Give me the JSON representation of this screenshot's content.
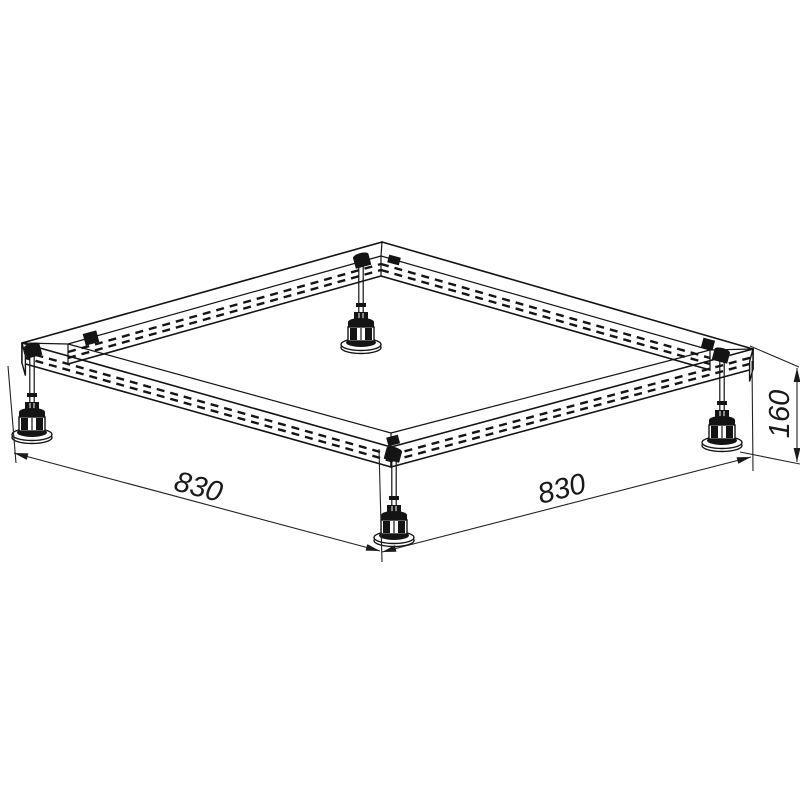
{
  "drawing": {
    "labels": {
      "width_left": "830",
      "width_right": "830",
      "height": "160"
    },
    "line_color": "#141414",
    "background_color": "#ffffff"
  }
}
